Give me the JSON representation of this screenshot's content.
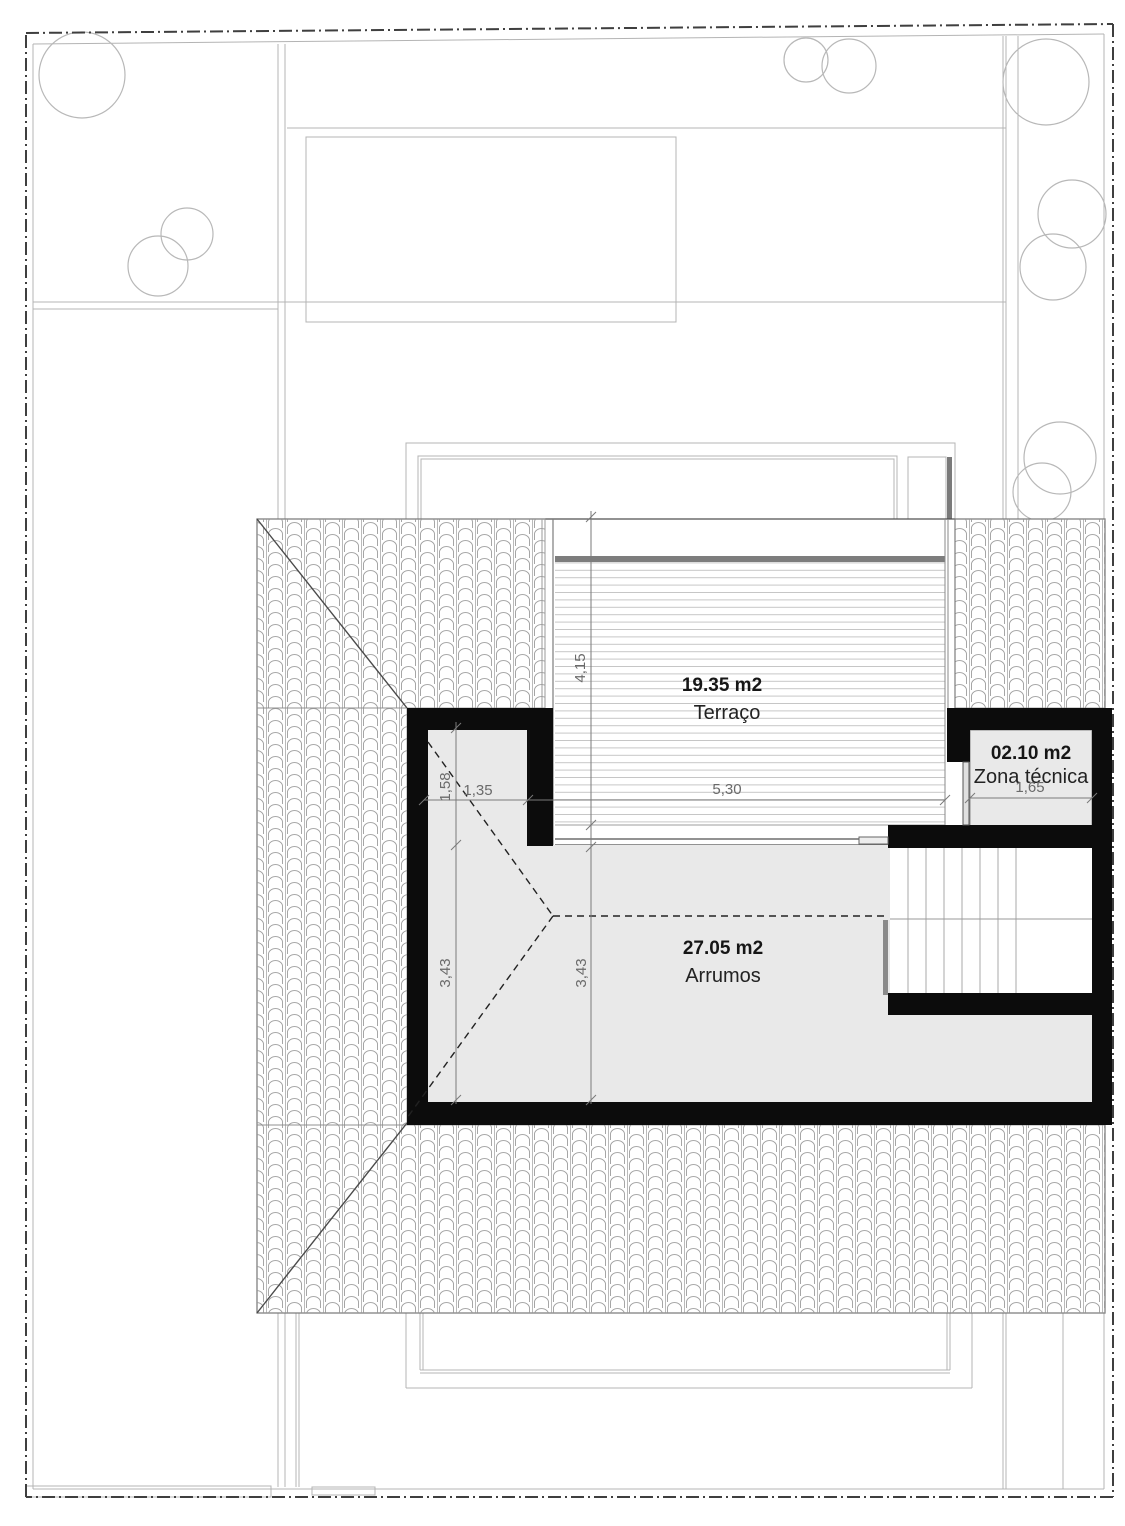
{
  "drawing": {
    "type": "roof-floor-plan",
    "rooms": {
      "terrace": {
        "area": "19.35 m2",
        "name": "Terraço"
      },
      "storage": {
        "area": "27.05 m2",
        "name": "Arrumos"
      },
      "technical": {
        "area": "02.10 m2",
        "name": "Zona técnica"
      }
    },
    "dimensions": {
      "terrace_depth": "4,15",
      "terrace_width": "5,30",
      "nook_depth": "1,58",
      "nook_width": "1,35",
      "storage_depth_left": "3,43",
      "storage_depth_center": "3,43",
      "technical_width": "1,65"
    },
    "colors": {
      "wall": "#0c0c0c",
      "room_fill": "#e9e9e9",
      "site_line": "#b4b4b4",
      "boundary_line": "#3f3f3f",
      "deck_bar": "#7d7d7d"
    }
  }
}
